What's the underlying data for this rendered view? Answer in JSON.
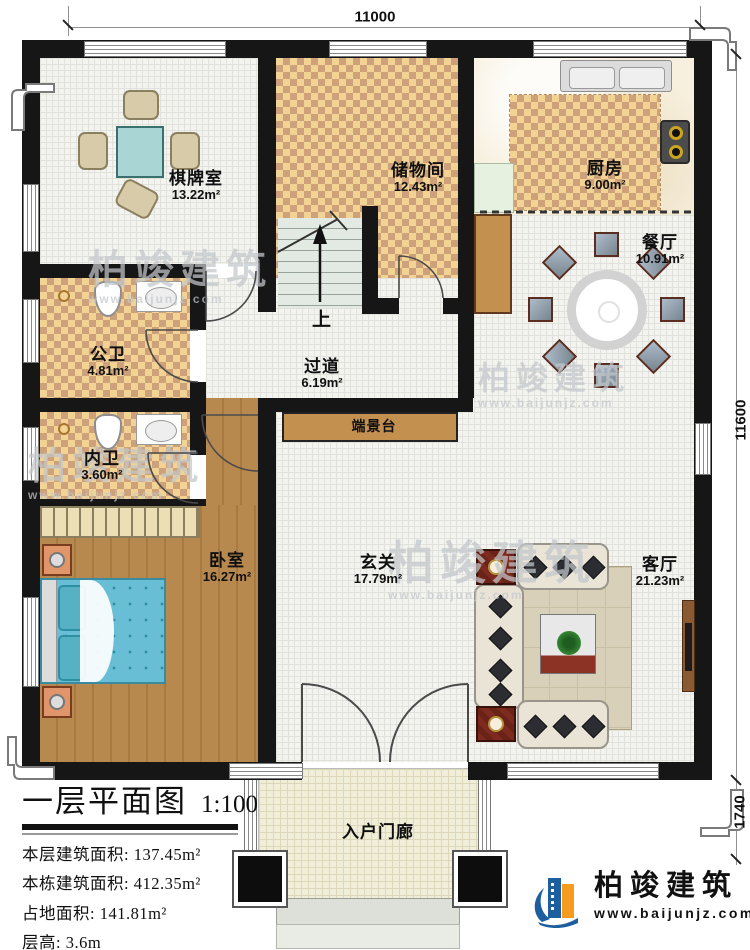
{
  "plan": {
    "title": "一层平面图",
    "scale": "1:100",
    "stats": [
      {
        "label": "本层建筑面积:",
        "value": "137.45m²"
      },
      {
        "label": "本栋建筑面积:",
        "value": "412.35m²"
      },
      {
        "label": "占地面积:",
        "value": "141.81m²"
      },
      {
        "label": "层高:",
        "value": "3.6m"
      }
    ]
  },
  "dimensions": {
    "top": "11000",
    "right": "11600",
    "porch": "1740"
  },
  "rooms": [
    {
      "name": "棋牌室",
      "area": "13.22m²"
    },
    {
      "name": "储物间",
      "area": "12.43m²"
    },
    {
      "name": "厨房",
      "area": "9.00m²"
    },
    {
      "name": "餐厅",
      "area": "10.91m²"
    },
    {
      "name": "公卫",
      "area": "4.81m²"
    },
    {
      "name": "过道",
      "area": "6.19m²"
    },
    {
      "name": "端景台",
      "area": ""
    },
    {
      "name": "内卫",
      "area": "3.60m²"
    },
    {
      "name": "卧室",
      "area": "16.27m²"
    },
    {
      "name": "玄关",
      "area": "17.79m²"
    },
    {
      "name": "客厅",
      "area": "21.23m²"
    },
    {
      "name": "入户门廊",
      "area": ""
    }
  ],
  "stairs": {
    "up_label": "上"
  },
  "branding": {
    "name": "柏竣建筑",
    "website": "www.baijunjz.com"
  },
  "colors": {
    "wall": "#161616",
    "checker_light": "#f2d393",
    "checker_dark": "#cda27b",
    "wood": "#b8894f",
    "console": "#c49050",
    "bed_blue": "#68bfd5",
    "brand_blue": "#1d5e9e",
    "brand_orange": "#f59b1e"
  }
}
